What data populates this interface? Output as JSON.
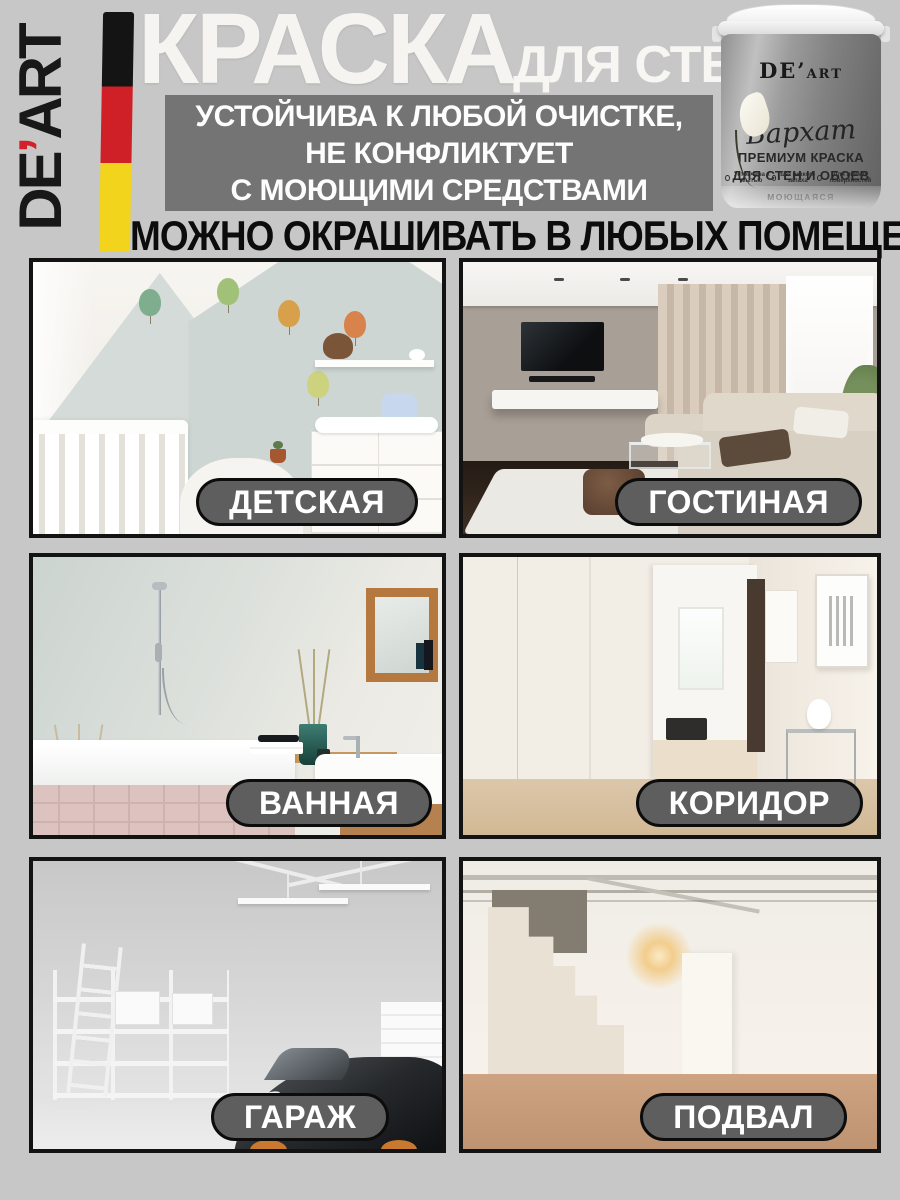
{
  "page": {
    "background": "#c7c7c7"
  },
  "brand": {
    "logo_de": "DE",
    "logo_apostrophe": "’",
    "logo_art": "ART"
  },
  "header": {
    "title_main": "КРАСКА",
    "title_sub": "ДЛЯ СТЕН",
    "benefit_line1": "УСТОЙЧИВА К ЛЮБОЙ ОЧИСТКЕ,",
    "benefit_line2": "НЕ КОНФЛИКТУЕТ",
    "benefit_line3": "С МОЮЩИМИ СРЕДСТВАМИ",
    "headline": "МОЖНО ОКРАШИВАТЬ В ЛЮБЫХ ПОМЕЩЕНИЯХ"
  },
  "product": {
    "brand_de": "DE’",
    "brand_art": "ART",
    "series": "Бархат",
    "type_line1": "ПРЕМИУМ КРАСКА",
    "type_line2": "ДЛЯ СТЕН И ОБОЕВ",
    "feature": "МОЮЩАЯСЯ",
    "badges": [
      "Устойчива к мытью",
      "Без резкого запаха",
      "Для любых поверхностей"
    ]
  },
  "rooms": [
    {
      "label": "ДЕТСКАЯ"
    },
    {
      "label": "ГОСТИНАЯ"
    },
    {
      "label": "ВАННАЯ"
    },
    {
      "label": "КОРИДОР"
    },
    {
      "label": "ГАРАЖ"
    },
    {
      "label": "ПОДВАЛ"
    }
  ],
  "colors": {
    "background": "#c7c7c7",
    "benefit_box": "#747474",
    "label_pill": "#5e5e5e",
    "flag_black": "#141414",
    "flag_red": "#cf2027",
    "flag_yellow": "#f2d41c",
    "headline_text": "#0c0c0c",
    "title_text": "#f6f4f1"
  }
}
